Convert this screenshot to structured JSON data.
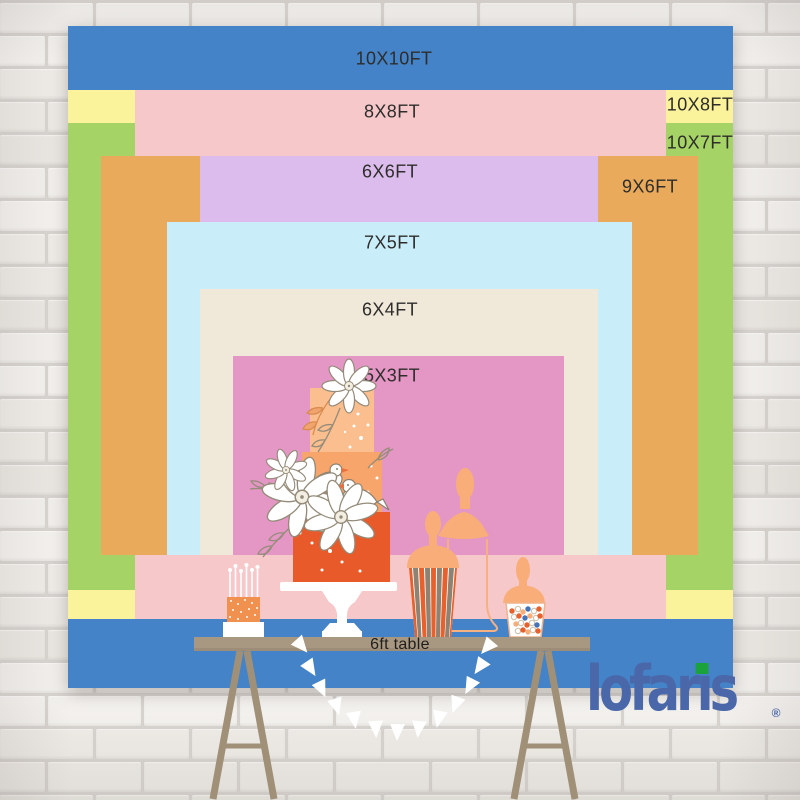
{
  "backdrop": {
    "label_color": "#2E2D2B",
    "sizes": [
      {
        "label": "10X10FT",
        "color": "#4483C7"
      },
      {
        "label": "10X8FT",
        "color": "#FAF39C"
      },
      {
        "label": "10X7FT",
        "color": "#A5D366"
      },
      {
        "label": "8X8FT",
        "color": "#F6C8CA"
      },
      {
        "label": "9X6FT",
        "color": "#EAAA5B"
      },
      {
        "label": "6X6FT",
        "color": "#DCBCEC"
      },
      {
        "label": "7X5FT",
        "color": "#C9EEF9"
      },
      {
        "label": "6X4FT",
        "color": "#F0E8D8"
      },
      {
        "label": "5X3FT",
        "color": "#E496C5"
      }
    ]
  },
  "table": {
    "label": "6ft table",
    "top_color": "#A89882",
    "leg_color": "#A09077"
  },
  "logo": {
    "text": "lofaris",
    "display_pre": "lofar",
    "display_i": "ı",
    "display_post": "s",
    "registered": "®",
    "color": "#4A67A9",
    "chip_color": "#1CA23C"
  },
  "wall": {
    "mortar": "#D9D5D1",
    "brick_shades": [
      "#F4F2EF",
      "#EFECE8",
      "#F6F4F1",
      "#ECE9E4",
      "#F1EEEA"
    ]
  },
  "decor": {
    "colors": {
      "cake_tier_top": "#FBBE8E",
      "cake_tier_mid": "#F8A56B",
      "cake_tier_bottom": "#E95A2B",
      "mini_cake": "#F0914F",
      "jar_peach": "#F9AE79",
      "stripe_gray": "#8E8273",
      "stripe_orange": "#E8602C",
      "candy_blue": "#4573B8"
    },
    "items": [
      "tiered-cake",
      "cake-stand",
      "mini-cake-with-candles",
      "popcorn-box",
      "candy-jar",
      "apothecary-jar",
      "pennant-garland",
      "flowers",
      "birds",
      "6ft-table"
    ]
  }
}
